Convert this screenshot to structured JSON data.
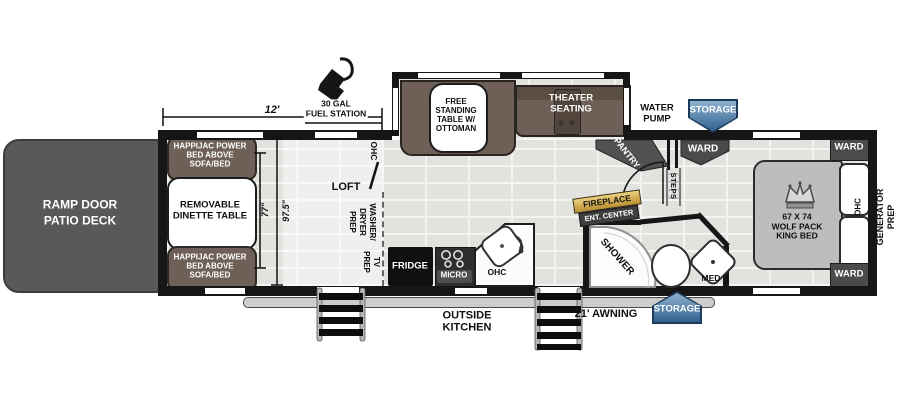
{
  "colors": {
    "wall": "#161616",
    "floor": "#e2e2df",
    "furniture_brown": "#6e6057",
    "deck_gray": "#59595b",
    "bed_gray": "#bdbdbd",
    "cabinet_gray": "#4b4b4d",
    "storage_badge_blue": "#31618f",
    "fireplace_gold": "#d9ac40"
  },
  "exterior": {
    "ramp_door": "RAMP DOOR\nPATIO DECK",
    "fuel_station": "30 GAL\nFUEL STATION",
    "water_pump": "WATER\nPUMP",
    "storage_front": "STORAGE",
    "storage_rear": "STORAGE",
    "awning": "21' AWNING",
    "outside_kitchen": "OUTSIDE\nKITCHEN",
    "generator_prep": "GENERATOR\nPREP"
  },
  "dimensions": {
    "garage_length": "12'",
    "garage_width": "77\"",
    "garage_width_full": "97.5\""
  },
  "garage": {
    "happijac_top": "HAPPIJAC POWER\nBED ABOVE\nSOFA/BED",
    "dinette_table": "REMOVABLE\nDINETTE TABLE",
    "happijac_bottom": "HAPPIJAC POWER\nBED ABOVE\nSOFA/BED",
    "loft": "LOFT",
    "ohc": "OHC",
    "washer_dryer_prep": "WASHER/\nDRYER\nPREP",
    "tv_prep": "TV\nPREP"
  },
  "living_area": {
    "free_standing_table": "FREE\nSTANDING\nTABLE W/\nOTTOMAN",
    "theater_seating": "THEATER\nSEATING",
    "fireplace": "FIREPLACE",
    "ent_center": "ENT. CENTER",
    "pantry": "PANTRY",
    "steps": "STEPS"
  },
  "kitchen": {
    "fridge": "FRIDGE",
    "micro": "MICRO",
    "ohc": "OHC"
  },
  "bathroom": {
    "shower": "SHOWER",
    "med": "MED"
  },
  "bedroom": {
    "king_bed": "67 X 74\nWOLF PACK\nKING BED",
    "ward_hall": "WARD",
    "ward_top": "WARD",
    "ward_bottom": "WARD",
    "ohc": "OHC"
  }
}
